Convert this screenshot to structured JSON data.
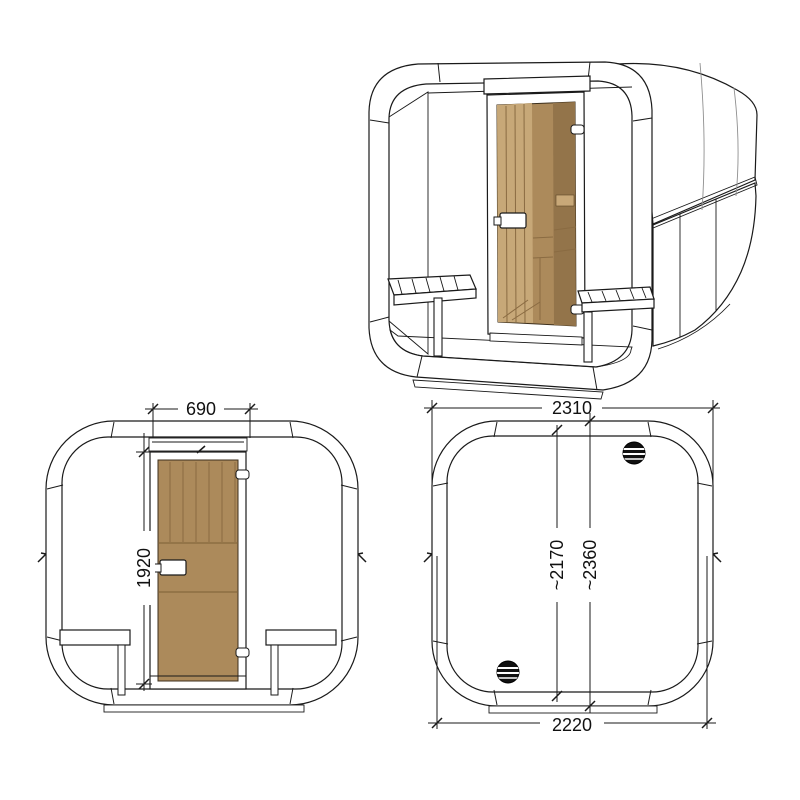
{
  "views": {
    "perspective": {
      "name": "perspective view of cube sauna"
    },
    "front": {
      "name": "front elevation",
      "dims": {
        "door_width": "690",
        "door_height": "1920"
      }
    },
    "rear": {
      "name": "rear elevation",
      "dims": {
        "overall_width": "2310",
        "inner_height": "~2170",
        "overall_height": "~2360",
        "base_width": "2220"
      }
    }
  },
  "colors": {
    "line": "#1a1a1a",
    "door_glass": "#ac8a5b",
    "door_glass_light": "#c7a878",
    "roof_base": "#a6a6a6",
    "roof_dot": "#6f6f6f"
  }
}
